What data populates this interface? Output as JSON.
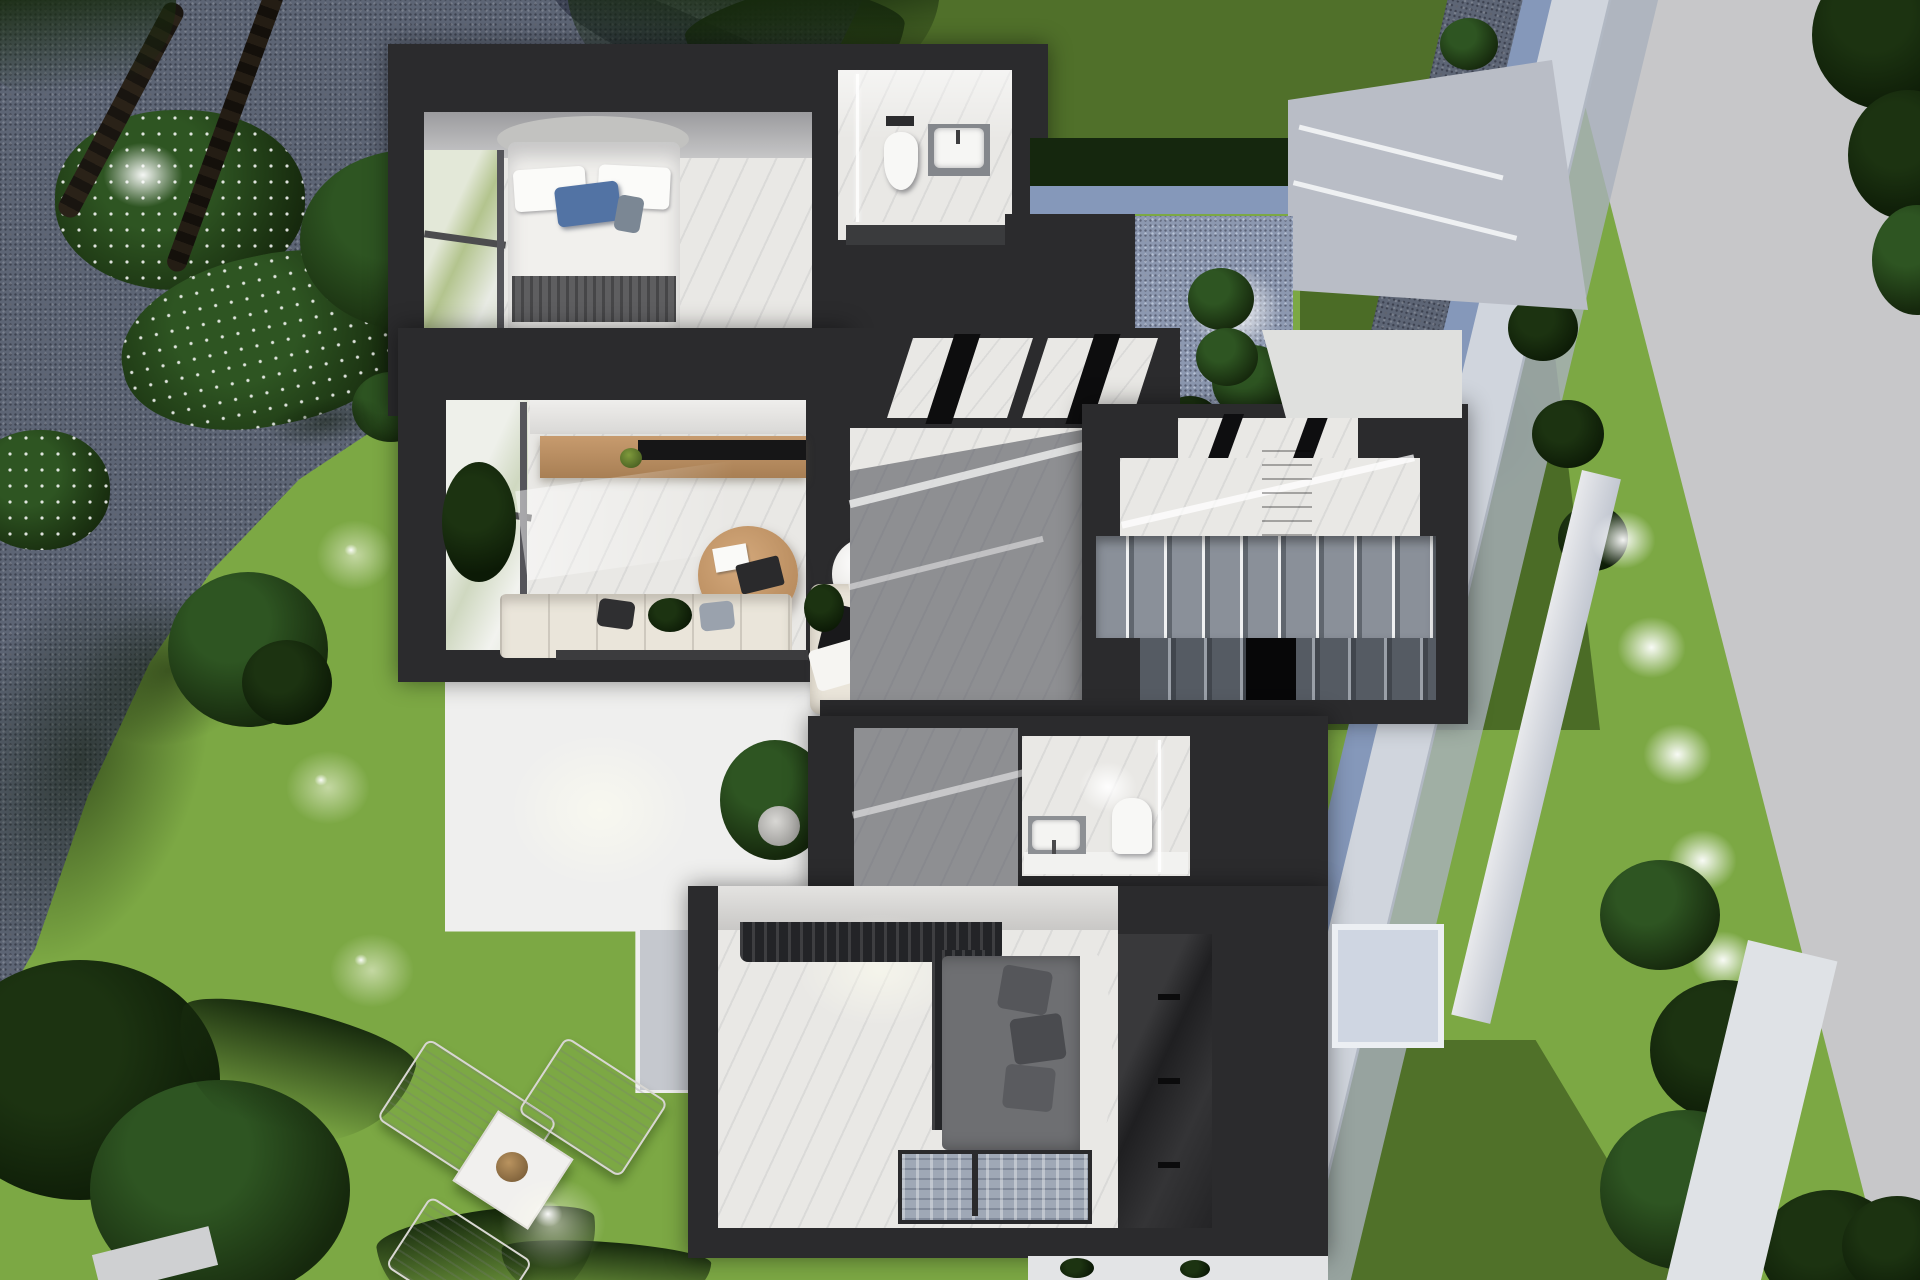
{
  "meta": {
    "title": "3D dollhouse floor-plan render of a modern villa upper floor with garden",
    "view": "top-down cutaway",
    "visible_text": "none"
  },
  "palette": {
    "wall": "#2b2b2d",
    "wall2": "#3a3b3d",
    "marble": "#e9e8e5",
    "floor_shadow": "#8e8f92",
    "lawn": "#7ca844",
    "lawn_shade": "#50702a",
    "hedge": "#15270e",
    "gravel": "#5d6575",
    "road": "#c7c7c9",
    "road_band": "#a9b0bd",
    "wall_face": "#d0d5dd",
    "wall_blue": "#8598ba",
    "terrace": "#efefee",
    "wood": "#c09166",
    "wood_dark": "#8c6b4a",
    "sofa": "#eae5da",
    "cushion_dark": "#232325",
    "pillow_blue": "#5273a4",
    "bed_white": "#f1f0ed",
    "throw_gray": "#5e5e60",
    "stair_light": "#8a9099",
    "stair_dark": "#60666e",
    "bed2": "#6e6f72",
    "rug": "#9fa8b6",
    "curtain": "#232427",
    "plant": "#2e5522",
    "plant_dark": "#16290d"
  },
  "scene": {
    "grounds": [
      "asphalt-road-right",
      "blue-gray-boundary-wall",
      "gravel-bed-with-bush-row",
      "lawn",
      "gravel-court-top-left",
      "white-terrace",
      "garden-spotlights",
      "palm-trees",
      "round-trees",
      "flower-bushes"
    ],
    "rooms": [
      {
        "id": "bedroom-1",
        "contents": [
          "double-bed",
          "blue-pillow",
          "gray-throw",
          "corner-window",
          "marble-floor"
        ]
      },
      {
        "id": "bathroom-1",
        "contents": [
          "wall-hung-toilet",
          "flush-plate",
          "washbasin",
          "glass-shower-screen",
          "vanity"
        ]
      },
      {
        "id": "entry-courtyard",
        "contents": [
          "gravel-floor",
          "spotlight",
          "plants"
        ]
      },
      {
        "id": "living-room",
        "contents": [
          "corner-window",
          "tv-sideboard",
          "tv",
          "round-coffee-table",
          "hanging-chair",
          "l-sofa",
          "accent-armchair",
          "black-pillow"
        ]
      },
      {
        "id": "hallway",
        "contents": [
          "marble-floor",
          "ceiling-beams",
          "sun-streaks"
        ]
      },
      {
        "id": "staircase",
        "contents": [
          "upper-flight",
          "lower-flight",
          "stairwell-gap",
          "landing",
          "wood-wardrobe",
          "skylight-beams"
        ]
      },
      {
        "id": "wc",
        "contents": [
          "toilet",
          "washbasin",
          "glass-screen",
          "ceiling-spot"
        ]
      },
      {
        "id": "bedroom-2",
        "contents": [
          "gray-bed",
          "pillows",
          "curved-headboard",
          "dark-curtains",
          "patterned-rug",
          "glossy-wardrobe"
        ]
      }
    ],
    "outdoor_furniture": [
      "sun-lounger-1",
      "sun-lounger-2",
      "sun-lounger-3",
      "square-side-table",
      "potted-plant"
    ]
  }
}
